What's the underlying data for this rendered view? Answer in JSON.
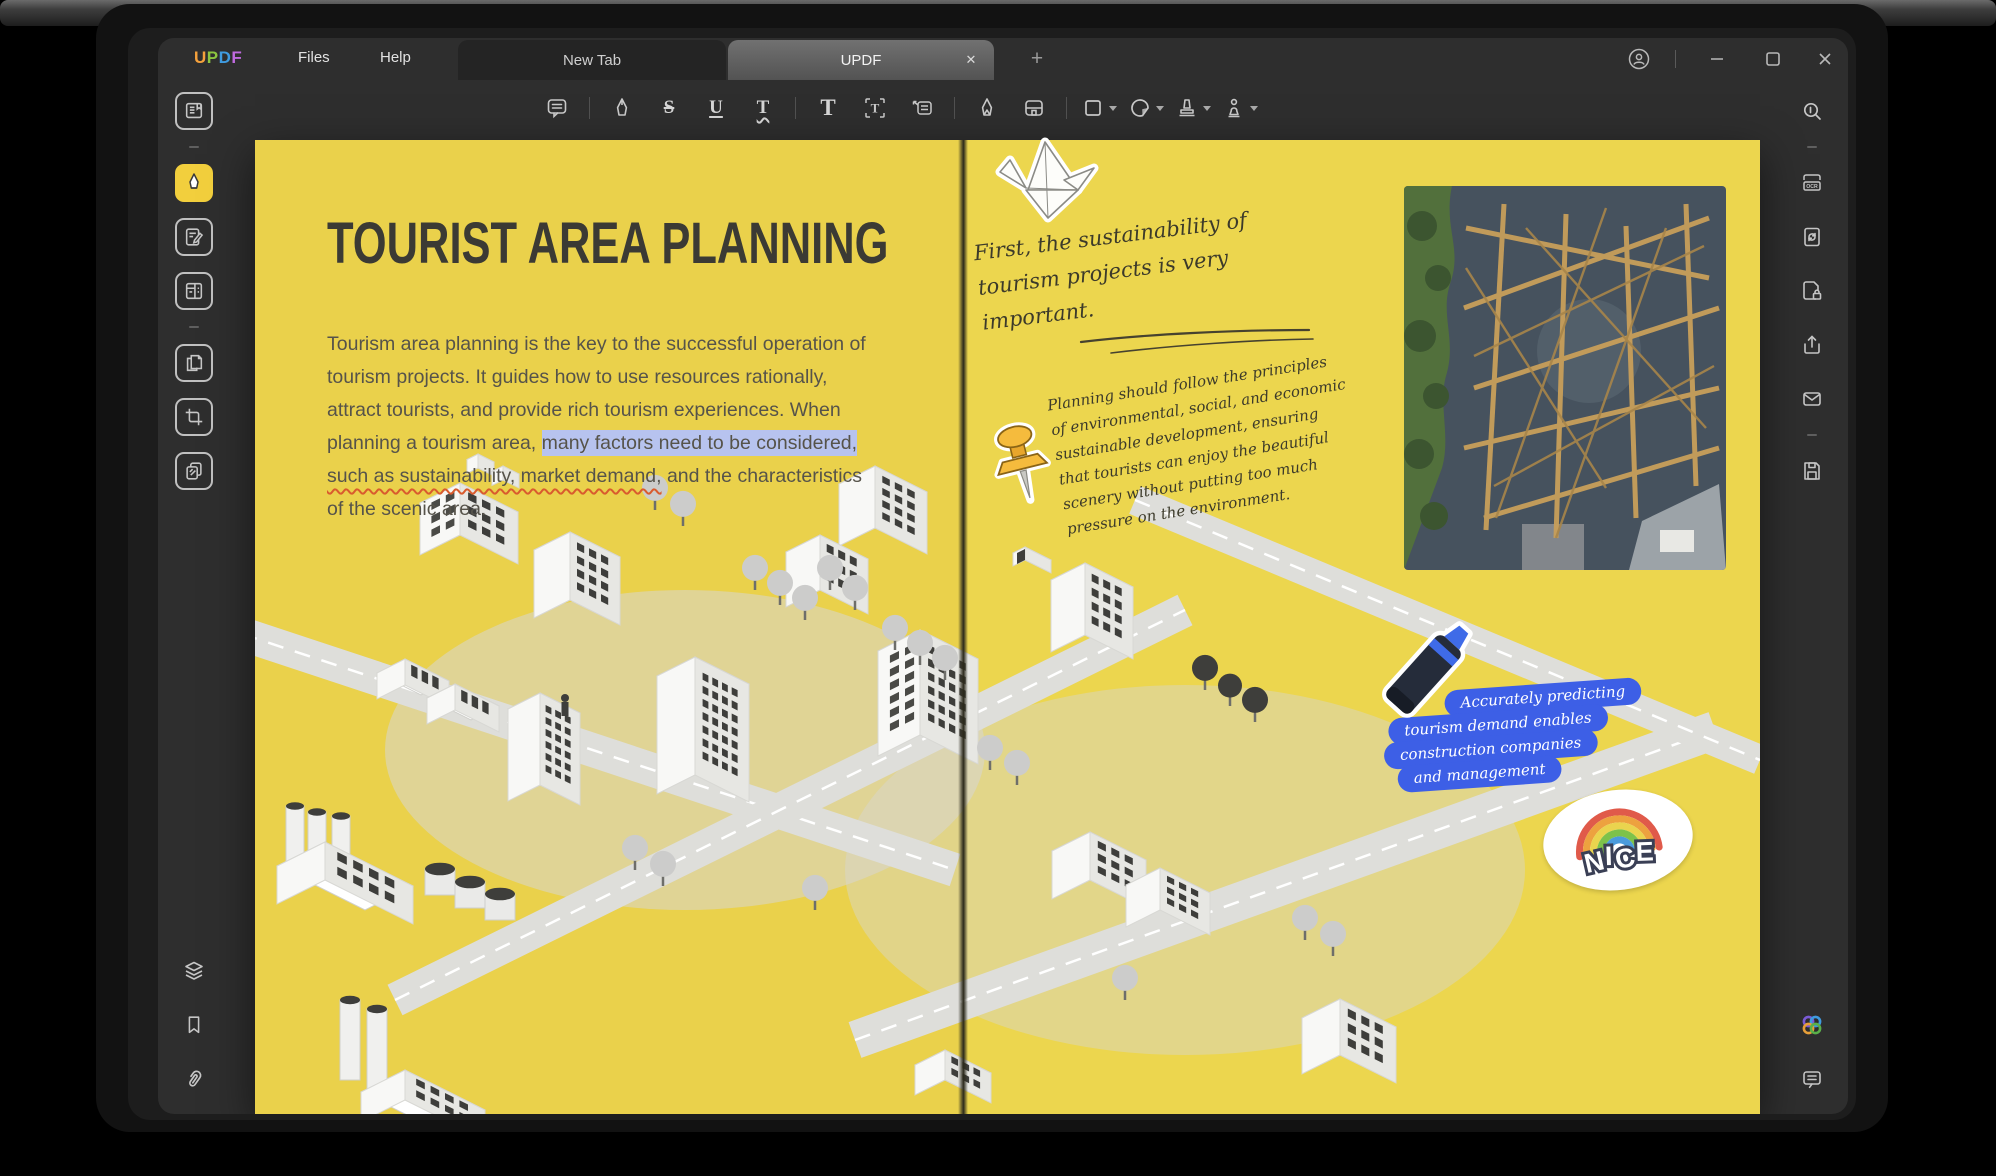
{
  "window": {
    "brand": "UPDF",
    "brand_letters": [
      {
        "ch": "U",
        "color": "#f5a13c"
      },
      {
        "ch": "P",
        "color": "#8bc540"
      },
      {
        "ch": "D",
        "color": "#3f9be0"
      },
      {
        "ch": "F",
        "color": "#c06ae0"
      }
    ],
    "menus": [
      "Files",
      "Help"
    ],
    "tabs": [
      {
        "label": "New Tab",
        "active": false
      },
      {
        "label": "UPDF",
        "active": true
      }
    ],
    "tab_close_glyph": "✕",
    "new_tab_glyph": "+",
    "controls": [
      "account",
      "minimize",
      "maximize",
      "close"
    ]
  },
  "toolbar": {
    "tools": [
      "comment",
      "highlighter",
      "strikeout",
      "underline",
      "squiggly-underline",
      "text-comment",
      "text-box",
      "text-callout",
      "pen",
      "eraser",
      "shape-rectangle",
      "sticker",
      "stamp",
      "signature"
    ],
    "letters": {
      "strikeout": "S",
      "underline": "U",
      "squiggly": "T",
      "text_comment": "T",
      "text_box": "T"
    }
  },
  "left_sidebar": {
    "tools": [
      "reader",
      "comment",
      "edit-pdf",
      "organize-pages",
      "page-tools",
      "crop-pages",
      "compare"
    ],
    "active": "comment",
    "bottom": [
      "thumbnails",
      "bookmarks",
      "attachments"
    ]
  },
  "right_sidebar": {
    "tools": [
      "search",
      "ocr",
      "convert",
      "protect",
      "share",
      "email",
      "save"
    ],
    "ocr_label": "OCR",
    "bottom": [
      "ai-assistant",
      "feedback"
    ]
  },
  "document": {
    "left_page": {
      "title": "TOURIST AREA PLANNING",
      "lines": [
        [
          {
            "t": "Tourism area planning is the key to the successful operation of",
            "s": "p"
          }
        ],
        [
          {
            "t": "tourism projects.  It guides how to use resources rationally,",
            "s": "p"
          }
        ],
        [
          {
            "t": "attract tourists, and provide rich tourism experiences. When",
            "s": "p"
          }
        ],
        [
          {
            "t": "planning a tourism area, ",
            "s": "p"
          },
          {
            "t": "many factors need to be considered,",
            "s": "hl"
          }
        ],
        [
          {
            "t": "such as sustainability, market demand,",
            "s": "sq"
          },
          {
            "t": " and the characteristics",
            "s": "p"
          }
        ],
        [
          {
            "t": "of the scenic area.",
            "s": "p"
          }
        ]
      ]
    },
    "right_page": {
      "note1_lines": [
        "First, the sustainability of",
        "tourism projects is very",
        "important."
      ],
      "note2_lines": [
        "Planning should follow the principles",
        "of environmental, social, and economic",
        "sustainable development, ensuring",
        "that tourists can enjoy the beautiful",
        "scenery without putting too much",
        "pressure on the environment."
      ],
      "highlight_lines": [
        "Accurately predicting",
        "tourism demand enables",
        "construction companies",
        "and management"
      ],
      "nice_label": "NICE"
    }
  },
  "colors": {
    "page_yellow_left": "#ead14b",
    "page_yellow_right": "#ecd64e",
    "annotation_highlight": "#b7c3ef",
    "squiggle_red": "#d95b2e",
    "strip_blue": "#3d5fe6",
    "active_tool_yellow": "#f2cf3d"
  }
}
